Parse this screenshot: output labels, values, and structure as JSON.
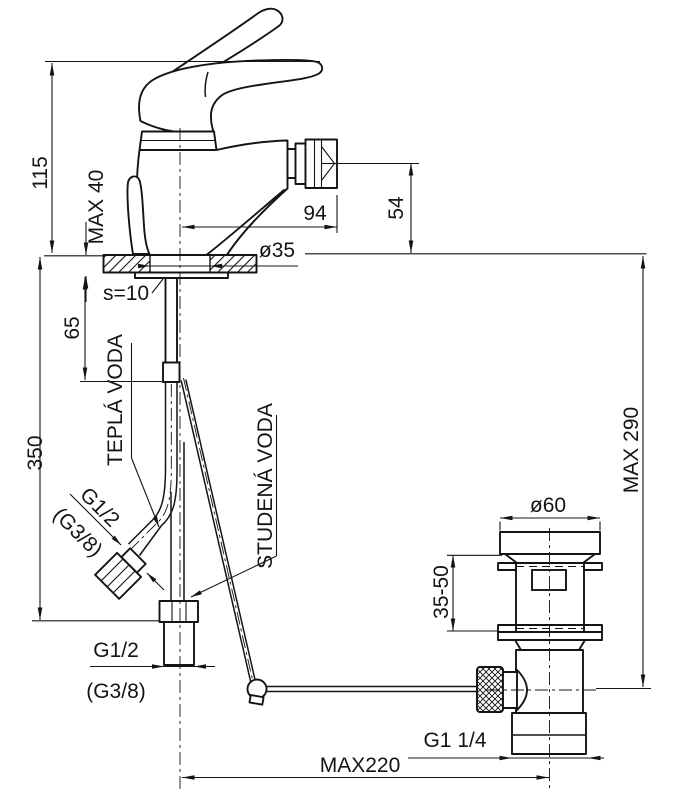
{
  "meta": {
    "description": "Technical installation drawing of a single-lever bidet mixer tap with pop-up waste, all dimensions in mm",
    "background": "#ffffff",
    "line_color": "#141414"
  },
  "dimensions": {
    "total_height": "115",
    "deck_thickness_max": "MAX 40",
    "spout_reach": "94",
    "spout_height": "54",
    "base_diameter": "ø35",
    "plate_thickness": "s=10",
    "shank_length": "65",
    "hose_length": "350",
    "drain_depth_max": "MAX 290",
    "waste_flange_diameter": "ø60",
    "clamping_range": "35-50",
    "rod_reach_max": "MAX220"
  },
  "labels": {
    "hot_water": "TEPLÁ VODA",
    "cold_water": "STUDENÁ VODA",
    "hose_thread": "G1/2",
    "hose_thread_alt": "(G3/8)",
    "supply_thread": "G1/2",
    "supply_thread_alt": "(G3/8)",
    "waste_thread": "G1 1/4"
  }
}
